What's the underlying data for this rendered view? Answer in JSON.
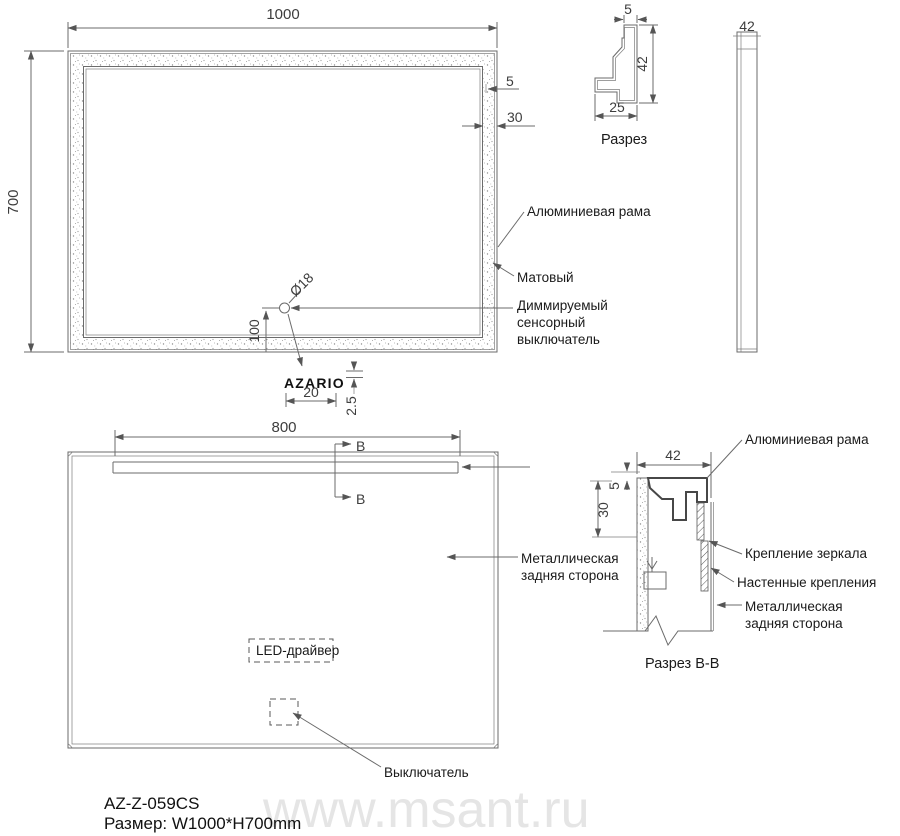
{
  "front": {
    "dim_width": "1000",
    "dim_height": "700",
    "dim_edge": "5",
    "dim_frame": "30",
    "dim_switch_dia": "Ø18",
    "dim_switch_offset": "100",
    "dim_logo_width": "20",
    "dim_logo_gap": "2.5",
    "logo": "AZARIO",
    "label_frame": "Алюминиевая рама",
    "label_matte": "Матовый",
    "label_switch_1": "Диммируемый",
    "label_switch_2": "сенсорный",
    "label_switch_3": "выключатель"
  },
  "profile": {
    "caption": "Разрез",
    "dim_top": "5",
    "dim_height": "42",
    "dim_width": "25"
  },
  "side": {
    "dim_depth": "42"
  },
  "back": {
    "dim_led": "800",
    "marker": "B",
    "label_back_1": "Металлическая",
    "label_back_2": "задняя сторона",
    "label_driver": "LED-драйвер",
    "label_switch": "Выключатель"
  },
  "section": {
    "caption": "Разрез B-B",
    "dim_width": "42",
    "dim_edge": "5",
    "dim_depth": "30",
    "label_frame": "Алюминиевая рама",
    "label_mirror_mount": "Крепление зеркала",
    "label_wall_mount": "Настенные крепления",
    "label_back_1": "Металлическая",
    "label_back_2": "задняя сторона"
  },
  "footer": {
    "model": "AZ-Z-059CS",
    "size": "Размер: W1000*H700mm"
  },
  "watermark": "www.msant.ru",
  "colors": {
    "line": "#6b6b6b",
    "text": "#1a1a1a",
    "watermark": "#e5e5e5"
  }
}
